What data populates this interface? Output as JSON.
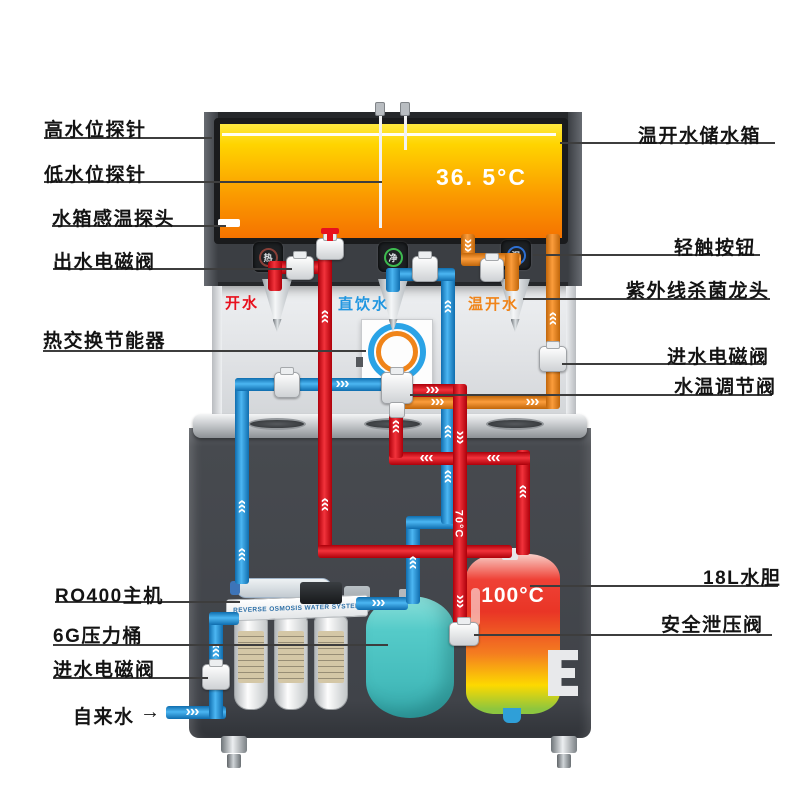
{
  "labels": {
    "left": [
      {
        "text": "高水位探针"
      },
      {
        "text": "低水位探针"
      },
      {
        "text": "水箱感温探头"
      },
      {
        "text": "出水电磁阀"
      },
      {
        "text": "热交换节能器"
      },
      {
        "text": "RO400主机"
      },
      {
        "text": "6G压力桶"
      },
      {
        "text": "进水电磁阀"
      },
      {
        "text": "自来水"
      }
    ],
    "right": [
      {
        "text": "温开水储水箱"
      },
      {
        "text": "轻触按钮"
      },
      {
        "text": "紫外线杀菌龙头"
      },
      {
        "text": "进水电磁阀"
      },
      {
        "text": "水温调节阀"
      },
      {
        "text": "18L水胆"
      },
      {
        "text": "安全泄压阀"
      }
    ],
    "inlet_arrow": "→"
  },
  "machine": {
    "storage_tank_temp": "36. 5°C",
    "boiler_temp": "100°C",
    "pipe_temp_label": "70°C",
    "ro_system_text": "REVERSE OSMOSIS WATER SYSTEM",
    "taps": [
      {
        "label": "开水",
        "color": "#e8101d"
      },
      {
        "label": "直饮水",
        "color": "#2196e0"
      },
      {
        "label": "温开水",
        "color": "#f08419"
      }
    ],
    "buttons": [
      {
        "glyph": "热",
        "ring_color": "#8a4038"
      },
      {
        "glyph": "净",
        "ring_color": "#3dbb4f"
      },
      {
        "glyph": "温",
        "ring_color": "#2e6fd0"
      }
    ]
  },
  "icons": {
    "flow_arrow": "›››"
  },
  "colors": {
    "hot_pipe": "#e8101d",
    "cold_pipe": "#2196e0",
    "warm_pipe": "#f08419",
    "pressure_tank": "#4fc4c4",
    "storage_tank_top": "#ffe93e",
    "storage_tank_bottom": "#f57300"
  }
}
